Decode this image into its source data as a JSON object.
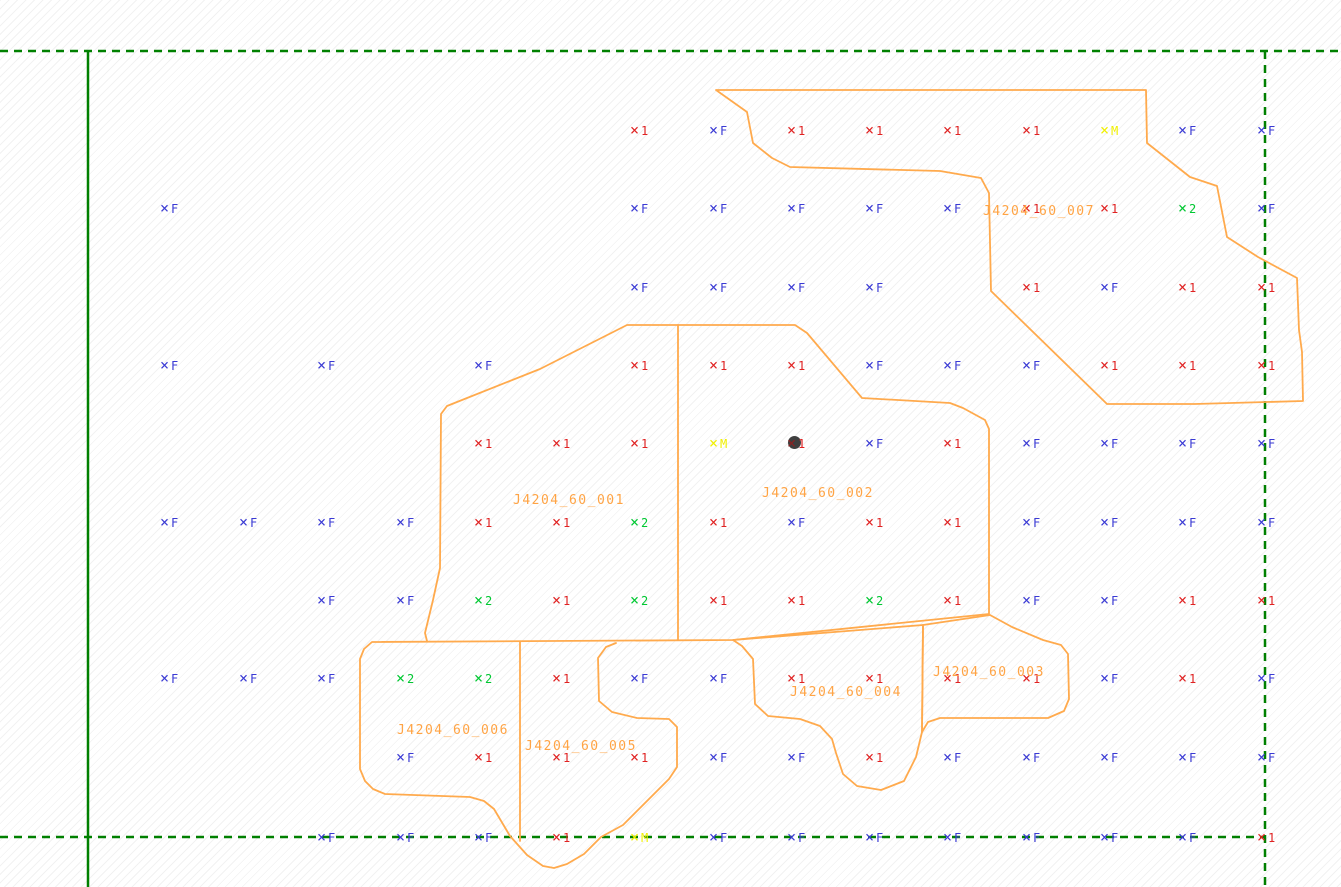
{
  "canvas": {
    "width": 1341,
    "height": 887
  },
  "colors": {
    "type_F": "#3a3ad4",
    "type_1": "#e02222",
    "type_2": "#00c832",
    "type_M": "#f0f000",
    "outline": "#ffaa4d",
    "zone_label": "#ffa445",
    "boundary_green": "#008000",
    "shot_dot": "#3f3f3f",
    "shot_dot_cross": "#8b2222"
  },
  "lines": [
    {
      "name": "survey-boundary-top",
      "style": "dashed",
      "x1": 0,
      "y1": 51,
      "x2": 1341,
      "y2": 51
    },
    {
      "name": "survey-boundary-bottom",
      "style": "dashed",
      "x1": 0,
      "y1": 837,
      "x2": 1265,
      "y2": 837
    },
    {
      "name": "survey-boundary-right",
      "style": "dashed",
      "x1": 1265,
      "y1": 51,
      "x2": 1265,
      "y2": 887
    },
    {
      "name": "baseline-vertical",
      "style": "solid",
      "x1": 88,
      "y1": 51,
      "x2": 88,
      "y2": 887
    }
  ],
  "zones": [
    {
      "id": "J4204_60_007",
      "label_x": 983,
      "label_y": 205
    },
    {
      "id": "J4204_60_001",
      "label_x": 513,
      "label_y": 494
    },
    {
      "id": "J4204_60_002",
      "label_x": 762,
      "label_y": 487
    },
    {
      "id": "J4204_60_003",
      "label_x": 933,
      "label_y": 666
    },
    {
      "id": "J4204_60_004",
      "label_x": 790,
      "label_y": 686
    },
    {
      "id": "J4204_60_005",
      "label_x": 525,
      "label_y": 740
    },
    {
      "id": "J4204_60_006",
      "label_x": 397,
      "label_y": 724
    }
  ],
  "outlines": [
    {
      "name": "zone-outline-J4204_60_007",
      "closed": true,
      "points": [
        [
          716,
          90
        ],
        [
          1146,
          90
        ],
        [
          1147,
          143
        ],
        [
          1190,
          177
        ],
        [
          1217,
          186
        ],
        [
          1227,
          237
        ],
        [
          1258,
          257
        ],
        [
          1297,
          278
        ],
        [
          1299,
          330
        ],
        [
          1302,
          352
        ],
        [
          1303,
          401
        ],
        [
          1195,
          404
        ],
        [
          1107,
          404
        ],
        [
          991,
          291
        ],
        [
          989,
          193
        ],
        [
          981,
          178
        ],
        [
          940,
          171
        ],
        [
          790,
          167
        ],
        [
          772,
          158
        ],
        [
          753,
          143
        ],
        [
          747,
          112
        ]
      ]
    },
    {
      "name": "zone-outline-J4204_60_001-002-outer",
      "closed": false,
      "points": [
        [
          427,
          641
        ],
        [
          425,
          633
        ],
        [
          433,
          600
        ],
        [
          440,
          568
        ],
        [
          441,
          414
        ],
        [
          447,
          406
        ],
        [
          457,
          402
        ],
        [
          540,
          369
        ],
        [
          627,
          325
        ],
        [
          795,
          325
        ],
        [
          807,
          333
        ],
        [
          862,
          398
        ],
        [
          950,
          403
        ],
        [
          963,
          408
        ],
        [
          985,
          420
        ],
        [
          989,
          429
        ],
        [
          989,
          614
        ],
        [
          733,
          640
        ],
        [
          372,
          642
        ],
        [
          364,
          649
        ],
        [
          360,
          659
        ],
        [
          360,
          769
        ],
        [
          365,
          781
        ],
        [
          373,
          789
        ],
        [
          385,
          794
        ],
        [
          470,
          797
        ],
        [
          484,
          801
        ],
        [
          494,
          809
        ],
        [
          510,
          836
        ],
        [
          527,
          855
        ],
        [
          543,
          866
        ],
        [
          554,
          868
        ],
        [
          567,
          864
        ],
        [
          584,
          854
        ],
        [
          601,
          837
        ],
        [
          623,
          825
        ],
        [
          651,
          797
        ],
        [
          669,
          779
        ],
        [
          677,
          767
        ],
        [
          677,
          727
        ],
        [
          669,
          719
        ],
        [
          637,
          718
        ],
        [
          612,
          712
        ],
        [
          599,
          701
        ],
        [
          598,
          658
        ],
        [
          606,
          647
        ],
        [
          616,
          643
        ]
      ]
    },
    {
      "name": "zone-divider-001-002",
      "closed": false,
      "points": [
        [
          678,
          325
        ],
        [
          678,
          640
        ]
      ]
    },
    {
      "name": "zone-divider-006-005",
      "closed": false,
      "points": [
        [
          520,
          642
        ],
        [
          520,
          841
        ]
      ]
    },
    {
      "name": "zone-outline-J4204_60_004",
      "closed": true,
      "points": [
        [
          733,
          640
        ],
        [
          923,
          625
        ],
        [
          922,
          732
        ],
        [
          916,
          757
        ],
        [
          904,
          781
        ],
        [
          881,
          790
        ],
        [
          857,
          786
        ],
        [
          843,
          774
        ],
        [
          836,
          753
        ],
        [
          832,
          739
        ],
        [
          820,
          726
        ],
        [
          800,
          719
        ],
        [
          768,
          716
        ],
        [
          755,
          704
        ],
        [
          753,
          659
        ],
        [
          742,
          646
        ]
      ]
    },
    {
      "name": "zone-outline-J4204_60_003",
      "closed": true,
      "points": [
        [
          923,
          625
        ],
        [
          990,
          615
        ],
        [
          1012,
          627
        ],
        [
          1043,
          640
        ],
        [
          1061,
          645
        ],
        [
          1068,
          654
        ],
        [
          1069,
          699
        ],
        [
          1064,
          711
        ],
        [
          1048,
          718
        ],
        [
          940,
          718
        ],
        [
          928,
          722
        ],
        [
          922,
          732
        ]
      ]
    }
  ],
  "markers": [
    {
      "x": 638,
      "y": 130,
      "t": "1"
    },
    {
      "x": 717,
      "y": 130,
      "t": "F"
    },
    {
      "x": 795,
      "y": 130,
      "t": "1"
    },
    {
      "x": 873,
      "y": 130,
      "t": "1"
    },
    {
      "x": 951,
      "y": 130,
      "t": "1"
    },
    {
      "x": 1030,
      "y": 130,
      "t": "1"
    },
    {
      "x": 1108,
      "y": 130,
      "t": "M"
    },
    {
      "x": 1186,
      "y": 130,
      "t": "F"
    },
    {
      "x": 1265,
      "y": 130,
      "t": "F"
    },
    {
      "x": 168,
      "y": 208,
      "t": "F"
    },
    {
      "x": 638,
      "y": 208,
      "t": "F"
    },
    {
      "x": 717,
      "y": 208,
      "t": "F"
    },
    {
      "x": 795,
      "y": 208,
      "t": "F"
    },
    {
      "x": 873,
      "y": 208,
      "t": "F"
    },
    {
      "x": 951,
      "y": 208,
      "t": "F"
    },
    {
      "x": 1030,
      "y": 208,
      "t": "1"
    },
    {
      "x": 1108,
      "y": 208,
      "t": "1"
    },
    {
      "x": 1186,
      "y": 208,
      "t": "2"
    },
    {
      "x": 1265,
      "y": 208,
      "t": "F"
    },
    {
      "x": 638,
      "y": 287,
      "t": "F"
    },
    {
      "x": 717,
      "y": 287,
      "t": "F"
    },
    {
      "x": 795,
      "y": 287,
      "t": "F"
    },
    {
      "x": 873,
      "y": 287,
      "t": "F"
    },
    {
      "x": 1030,
      "y": 287,
      "t": "1"
    },
    {
      "x": 1108,
      "y": 287,
      "t": "F"
    },
    {
      "x": 1186,
      "y": 287,
      "t": "1"
    },
    {
      "x": 1265,
      "y": 287,
      "t": "1"
    },
    {
      "x": 168,
      "y": 365,
      "t": "F"
    },
    {
      "x": 325,
      "y": 365,
      "t": "F"
    },
    {
      "x": 482,
      "y": 365,
      "t": "F"
    },
    {
      "x": 638,
      "y": 365,
      "t": "1"
    },
    {
      "x": 717,
      "y": 365,
      "t": "1"
    },
    {
      "x": 795,
      "y": 365,
      "t": "1"
    },
    {
      "x": 873,
      "y": 365,
      "t": "F"
    },
    {
      "x": 951,
      "y": 365,
      "t": "F"
    },
    {
      "x": 1030,
      "y": 365,
      "t": "F"
    },
    {
      "x": 1108,
      "y": 365,
      "t": "1"
    },
    {
      "x": 1186,
      "y": 365,
      "t": "1"
    },
    {
      "x": 1265,
      "y": 365,
      "t": "1"
    },
    {
      "x": 482,
      "y": 443,
      "t": "1"
    },
    {
      "x": 560,
      "y": 443,
      "t": "1"
    },
    {
      "x": 638,
      "y": 443,
      "t": "1"
    },
    {
      "x": 717,
      "y": 443,
      "t": "M"
    },
    {
      "x": 795,
      "y": 443,
      "t": "1",
      "dot": true
    },
    {
      "x": 873,
      "y": 443,
      "t": "F"
    },
    {
      "x": 951,
      "y": 443,
      "t": "1"
    },
    {
      "x": 1030,
      "y": 443,
      "t": "F"
    },
    {
      "x": 1108,
      "y": 443,
      "t": "F"
    },
    {
      "x": 1186,
      "y": 443,
      "t": "F"
    },
    {
      "x": 1265,
      "y": 443,
      "t": "F"
    },
    {
      "x": 168,
      "y": 522,
      "t": "F"
    },
    {
      "x": 247,
      "y": 522,
      "t": "F"
    },
    {
      "x": 325,
      "y": 522,
      "t": "F"
    },
    {
      "x": 404,
      "y": 522,
      "t": "F"
    },
    {
      "x": 482,
      "y": 522,
      "t": "1"
    },
    {
      "x": 560,
      "y": 522,
      "t": "1"
    },
    {
      "x": 638,
      "y": 522,
      "t": "2"
    },
    {
      "x": 717,
      "y": 522,
      "t": "1"
    },
    {
      "x": 795,
      "y": 522,
      "t": "F"
    },
    {
      "x": 873,
      "y": 522,
      "t": "1"
    },
    {
      "x": 951,
      "y": 522,
      "t": "1"
    },
    {
      "x": 1030,
      "y": 522,
      "t": "F"
    },
    {
      "x": 1108,
      "y": 522,
      "t": "F"
    },
    {
      "x": 1186,
      "y": 522,
      "t": "F"
    },
    {
      "x": 1265,
      "y": 522,
      "t": "F"
    },
    {
      "x": 325,
      "y": 600,
      "t": "F"
    },
    {
      "x": 404,
      "y": 600,
      "t": "F"
    },
    {
      "x": 482,
      "y": 600,
      "t": "2"
    },
    {
      "x": 560,
      "y": 600,
      "t": "1"
    },
    {
      "x": 638,
      "y": 600,
      "t": "2"
    },
    {
      "x": 717,
      "y": 600,
      "t": "1"
    },
    {
      "x": 795,
      "y": 600,
      "t": "1"
    },
    {
      "x": 873,
      "y": 600,
      "t": "2"
    },
    {
      "x": 951,
      "y": 600,
      "t": "1"
    },
    {
      "x": 1030,
      "y": 600,
      "t": "F"
    },
    {
      "x": 1108,
      "y": 600,
      "t": "F"
    },
    {
      "x": 1186,
      "y": 600,
      "t": "1"
    },
    {
      "x": 1265,
      "y": 600,
      "t": "1"
    },
    {
      "x": 168,
      "y": 678,
      "t": "F"
    },
    {
      "x": 247,
      "y": 678,
      "t": "F"
    },
    {
      "x": 325,
      "y": 678,
      "t": "F"
    },
    {
      "x": 404,
      "y": 678,
      "t": "2"
    },
    {
      "x": 482,
      "y": 678,
      "t": "2"
    },
    {
      "x": 560,
      "y": 678,
      "t": "1"
    },
    {
      "x": 638,
      "y": 678,
      "t": "F"
    },
    {
      "x": 717,
      "y": 678,
      "t": "F"
    },
    {
      "x": 795,
      "y": 678,
      "t": "1"
    },
    {
      "x": 873,
      "y": 678,
      "t": "1"
    },
    {
      "x": 951,
      "y": 678,
      "t": "1"
    },
    {
      "x": 1030,
      "y": 678,
      "t": "1"
    },
    {
      "x": 1108,
      "y": 678,
      "t": "F"
    },
    {
      "x": 1186,
      "y": 678,
      "t": "1"
    },
    {
      "x": 1265,
      "y": 678,
      "t": "F"
    },
    {
      "x": 404,
      "y": 757,
      "t": "F"
    },
    {
      "x": 482,
      "y": 757,
      "t": "1"
    },
    {
      "x": 560,
      "y": 757,
      "t": "1"
    },
    {
      "x": 638,
      "y": 757,
      "t": "1"
    },
    {
      "x": 717,
      "y": 757,
      "t": "F"
    },
    {
      "x": 795,
      "y": 757,
      "t": "F"
    },
    {
      "x": 873,
      "y": 757,
      "t": "1"
    },
    {
      "x": 951,
      "y": 757,
      "t": "F"
    },
    {
      "x": 1030,
      "y": 757,
      "t": "F"
    },
    {
      "x": 1108,
      "y": 757,
      "t": "F"
    },
    {
      "x": 1186,
      "y": 757,
      "t": "F"
    },
    {
      "x": 1265,
      "y": 757,
      "t": "F"
    },
    {
      "x": 325,
      "y": 837,
      "t": "F"
    },
    {
      "x": 404,
      "y": 837,
      "t": "F"
    },
    {
      "x": 482,
      "y": 837,
      "t": "F"
    },
    {
      "x": 560,
      "y": 837,
      "t": "1"
    },
    {
      "x": 638,
      "y": 837,
      "t": "M"
    },
    {
      "x": 717,
      "y": 837,
      "t": "F"
    },
    {
      "x": 795,
      "y": 837,
      "t": "F"
    },
    {
      "x": 873,
      "y": 837,
      "t": "F"
    },
    {
      "x": 951,
      "y": 837,
      "t": "F"
    },
    {
      "x": 1030,
      "y": 837,
      "t": "F"
    },
    {
      "x": 1108,
      "y": 837,
      "t": "F"
    },
    {
      "x": 1186,
      "y": 837,
      "t": "F"
    },
    {
      "x": 1265,
      "y": 837,
      "t": "1"
    }
  ],
  "marker_glyph": "×"
}
